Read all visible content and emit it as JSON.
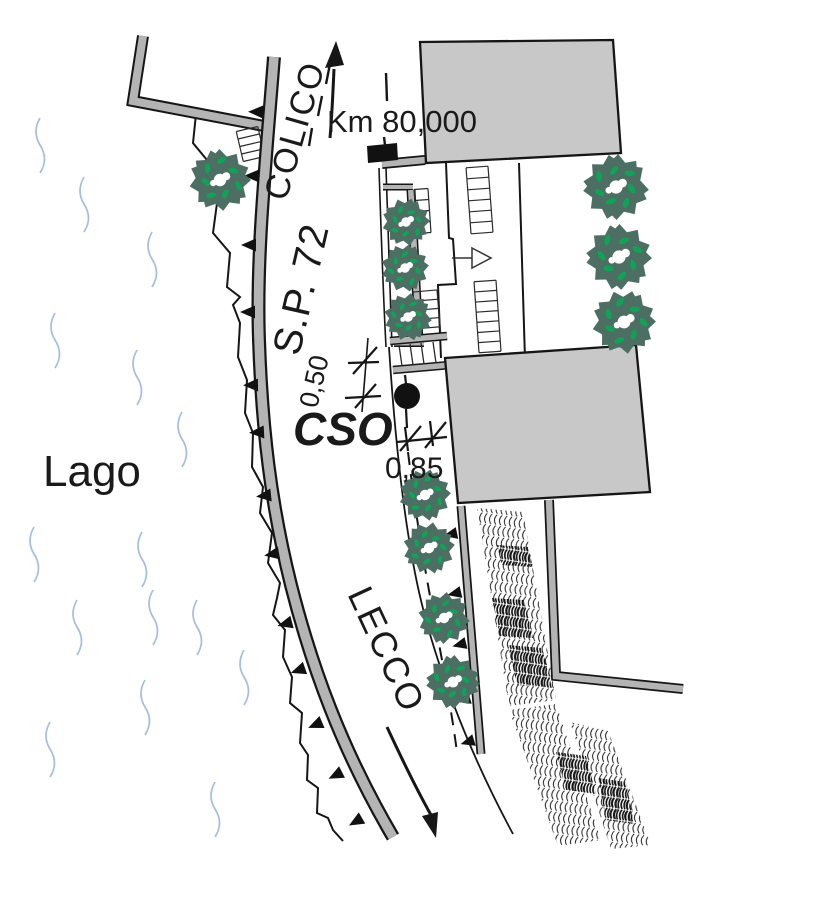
{
  "map": {
    "labels": {
      "lake": "Lago",
      "road": "S.P. 72",
      "direction_north": "COLICO",
      "direction_south": "LECCO",
      "km_marker": "Km 80,000",
      "outfall": "CSO",
      "dim_upper": "0,50",
      "dim_lower": "0,85"
    },
    "colors": {
      "ink": "#1a1a1a",
      "building_fill": "#c8c8c8",
      "wall_gray": "#b4b4b4",
      "tree_dark": "#4c6e63",
      "tree_accent": "#10a257",
      "water_blue": "#a4bedf",
      "white": "#ffffff"
    }
  }
}
